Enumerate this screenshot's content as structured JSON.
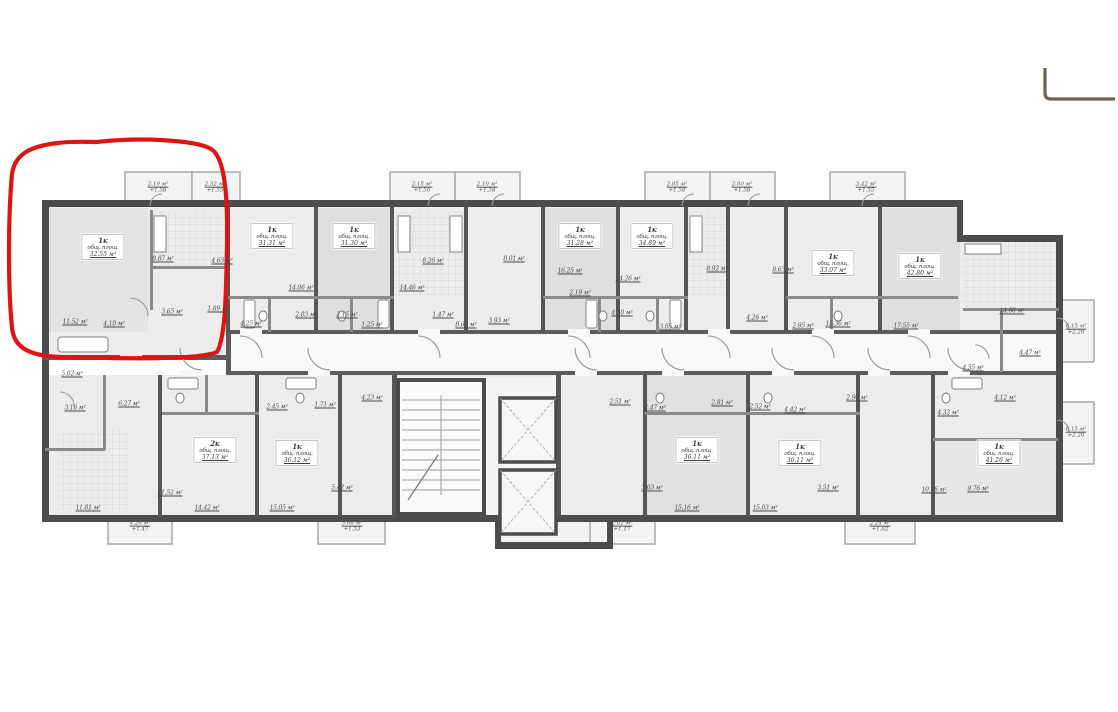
{
  "annotation": {
    "color": "#dd1414"
  },
  "corner_mark": {
    "color": "#6e6254"
  },
  "plan": {
    "units": [
      {
        "type": "1к",
        "note": "общ. площ.",
        "area": "32.55 м²",
        "x": 103,
        "y": 247
      },
      {
        "type": "1к",
        "note": "общ. площ.",
        "area": "31.31 м²",
        "x": 272,
        "y": 236
      },
      {
        "type": "1к",
        "note": "общ. площ.",
        "area": "31.30 м²",
        "x": 354,
        "y": 236
      },
      {
        "type": "1к",
        "note": "общ. площ.",
        "area": "31.28 м²",
        "x": 580,
        "y": 236
      },
      {
        "type": "1к",
        "note": "общ. площ.",
        "area": "34.89 м²",
        "x": 652,
        "y": 236
      },
      {
        "type": "1к",
        "note": "общ. площ.",
        "area": "33.07 м²",
        "x": 833,
        "y": 263
      },
      {
        "type": "1к",
        "note": "общ. площ.",
        "area": "42.80 м²",
        "x": 920,
        "y": 266
      },
      {
        "type": "2к",
        "note": "общ. площ.",
        "area": "37.13 м²",
        "x": 215,
        "y": 450
      },
      {
        "type": "1к",
        "note": "общ. площ.",
        "area": "36.12 м²",
        "x": 297,
        "y": 453
      },
      {
        "type": "1к",
        "note": "общ. площ.",
        "area": "36.11 м²",
        "x": 697,
        "y": 450
      },
      {
        "type": "1к",
        "note": "общ. площ.",
        "area": "36.11 м²",
        "x": 800,
        "y": 453
      },
      {
        "type": "1к",
        "note": "общ. площ.",
        "area": "41.26 м²",
        "x": 999,
        "y": 453
      }
    ],
    "room_labels": [
      {
        "t": "8.87 м²",
        "x": 163,
        "y": 259
      },
      {
        "t": "4.63 м²",
        "x": 222,
        "y": 261
      },
      {
        "t": "11.52 м²",
        "x": 75,
        "y": 322
      },
      {
        "t": "4.10 м²",
        "x": 114,
        "y": 324
      },
      {
        "t": "3.65 м²",
        "x": 172,
        "y": 312
      },
      {
        "t": "1.89 м²",
        "x": 218,
        "y": 309
      },
      {
        "t": "14.06 м²",
        "x": 301,
        "y": 288
      },
      {
        "t": "14.46 м²",
        "x": 412,
        "y": 288
      },
      {
        "t": "8.26 м²",
        "x": 433,
        "y": 261
      },
      {
        "t": "8.01 м²",
        "x": 514,
        "y": 259
      },
      {
        "t": "2.03 м²",
        "x": 306,
        "y": 315
      },
      {
        "t": "2.15 м²",
        "x": 347,
        "y": 315
      },
      {
        "t": "4.25 м²",
        "x": 251,
        "y": 324
      },
      {
        "t": "1.25 м²",
        "x": 372,
        "y": 325
      },
      {
        "t": "1.47 м²",
        "x": 443,
        "y": 315
      },
      {
        "t": "3.93 м²",
        "x": 499,
        "y": 321
      },
      {
        "t": "8.66 м²",
        "x": 466,
        "y": 325
      },
      {
        "t": "16.25 м²",
        "x": 570,
        "y": 271
      },
      {
        "t": "14.26 м²",
        "x": 628,
        "y": 279
      },
      {
        "t": "2.19 м²",
        "x": 580,
        "y": 293
      },
      {
        "t": "8.92 м²",
        "x": 717,
        "y": 269
      },
      {
        "t": "8.63 м²",
        "x": 783,
        "y": 270
      },
      {
        "t": "4.30 м²",
        "x": 622,
        "y": 313
      },
      {
        "t": "3.05 м²",
        "x": 670,
        "y": 327
      },
      {
        "t": "4.26 м²",
        "x": 757,
        "y": 318
      },
      {
        "t": "2.95 м²",
        "x": 803,
        "y": 326
      },
      {
        "t": "15.36 м²",
        "x": 838,
        "y": 324
      },
      {
        "t": "17.55 м²",
        "x": 906,
        "y": 326
      },
      {
        "t": "14.60 м²",
        "x": 1012,
        "y": 311
      },
      {
        "t": "4.47 м²",
        "x": 1030,
        "y": 353
      },
      {
        "t": "4.35 м²",
        "x": 973,
        "y": 368
      },
      {
        "t": "4.32 м²",
        "x": 948,
        "y": 413
      },
      {
        "t": "4.12 м²",
        "x": 1005,
        "y": 398
      },
      {
        "t": "10.16 м²",
        "x": 934,
        "y": 490
      },
      {
        "t": "9.76 м²",
        "x": 978,
        "y": 489
      },
      {
        "t": "5.02 м²",
        "x": 72,
        "y": 374
      },
      {
        "t": "3.16 м²",
        "x": 75,
        "y": 408
      },
      {
        "t": "6.27 м²",
        "x": 129,
        "y": 404
      },
      {
        "t": "11.81 м²",
        "x": 88,
        "y": 508
      },
      {
        "t": "11.52 м²",
        "x": 170,
        "y": 493
      },
      {
        "t": "14.42 м²",
        "x": 207,
        "y": 508
      },
      {
        "t": "15.05 м²",
        "x": 282,
        "y": 508
      },
      {
        "t": "2.45 м²",
        "x": 277,
        "y": 407
      },
      {
        "t": "1.71 м²",
        "x": 325,
        "y": 405
      },
      {
        "t": "4.23 м²",
        "x": 372,
        "y": 398
      },
      {
        "t": "5.42 м²",
        "x": 342,
        "y": 488
      },
      {
        "t": "2.51 м²",
        "x": 620,
        "y": 402
      },
      {
        "t": "4.47 м²",
        "x": 655,
        "y": 408
      },
      {
        "t": "2.81 м²",
        "x": 722,
        "y": 403
      },
      {
        "t": "2.52 м²",
        "x": 760,
        "y": 407
      },
      {
        "t": "4.42 м²",
        "x": 795,
        "y": 410
      },
      {
        "t": "2.96 м²",
        "x": 857,
        "y": 398
      },
      {
        "t": "3.03 м²",
        "x": 652,
        "y": 488
      },
      {
        "t": "3.51 м²",
        "x": 828,
        "y": 488
      },
      {
        "t": "15.16 м²",
        "x": 687,
        "y": 508
      },
      {
        "t": "15.03 м²",
        "x": 765,
        "y": 508
      }
    ],
    "balcony_labels": [
      {
        "a": "2.19 м²",
        "b": "+1.58",
        "x": 158,
        "y": 188
      },
      {
        "a": "2.32 м²",
        "b": "+1.55",
        "x": 215,
        "y": 188
      },
      {
        "a": "2.15 м²",
        "b": "+1.56",
        "x": 422,
        "y": 188
      },
      {
        "a": "2.10 м²",
        "b": "+1.58",
        "x": 487,
        "y": 188
      },
      {
        "a": "2.05 м²",
        "b": "+1.58",
        "x": 677,
        "y": 188
      },
      {
        "a": "2.00 м²",
        "b": "+1.58",
        "x": 742,
        "y": 188
      },
      {
        "a": "3.42 м²",
        "b": "+1.55",
        "x": 866,
        "y": 188
      },
      {
        "a": "6.15 м²",
        "b": "+2.20",
        "x": 1076,
        "y": 330
      },
      {
        "a": "6.15 м²",
        "b": "+2.20",
        "x": 1076,
        "y": 433
      },
      {
        "a": "4.26 м²",
        "b": "+1.47",
        "x": 140,
        "y": 527
      },
      {
        "a": "3.06 м²",
        "b": "+1.53",
        "x": 352,
        "y": 527
      },
      {
        "a": "2.02 м²",
        "b": "+1.17",
        "x": 622,
        "y": 527
      },
      {
        "a": "2.24 м²",
        "b": "+1.62",
        "x": 880,
        "y": 527
      }
    ]
  }
}
